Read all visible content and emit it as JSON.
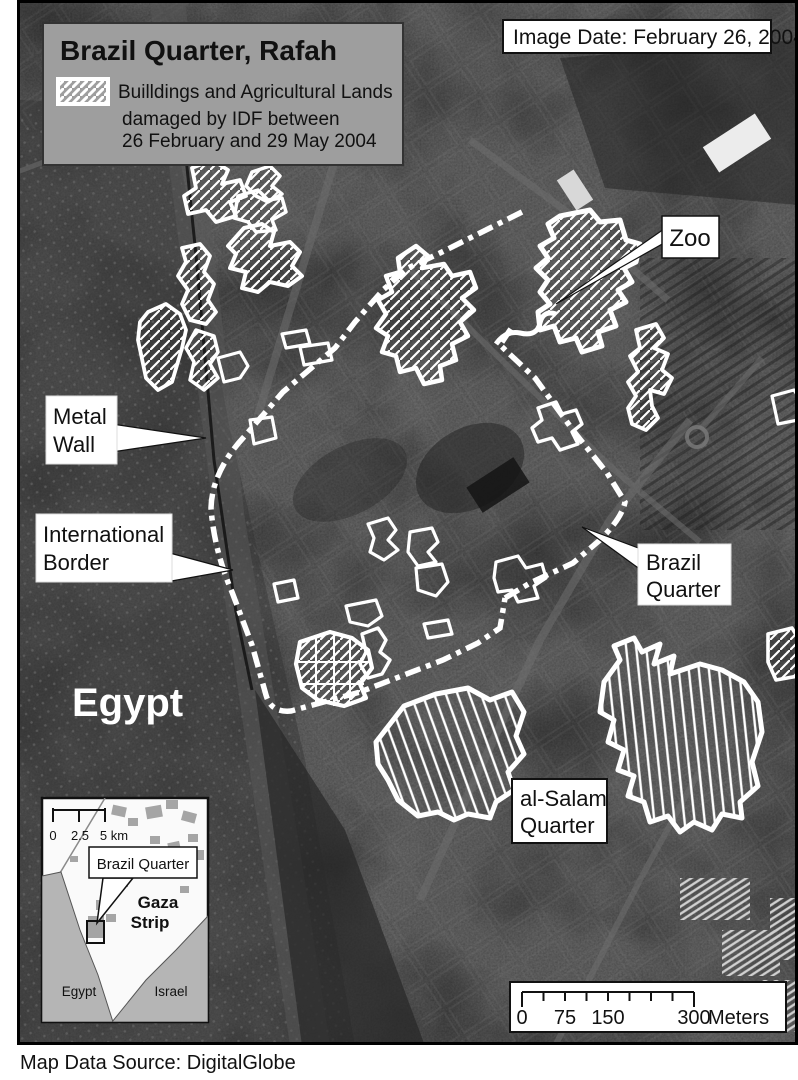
{
  "colors": {
    "map_background": "#3b3b3b",
    "panel_gray": "#9e9e9e",
    "callout_white": "#ffffff",
    "outline_black": "#111111",
    "damage_outline_white": "#ffffff",
    "inset_neighbor_gray": "#b5b5b5"
  },
  "title_panel": {
    "title": "Brazil Quarter, Rafah",
    "legend_line1": "Builldings and Agricultural Lands",
    "legend_line2": "damaged by IDF between",
    "legend_line3": "26 February and 29 May 2004"
  },
  "image_date_label": "Image Date: February 26, 2004",
  "map_labels": {
    "zoo": "Zoo",
    "metal_wall_line1": "Metal",
    "metal_wall_line2": "Wall",
    "border_line1": "International",
    "border_line2": "Border",
    "egypt": "Egypt",
    "brazil_quarter_line1": "Brazil",
    "brazil_quarter_line2": "Quarter",
    "al_salam_line1": "al-Salam",
    "al_salam_line2": "Quarter"
  },
  "inset_map": {
    "scale_zero": "0",
    "scale_mid": "2.5",
    "scale_end": "5 km",
    "callout": "Brazil Quarter",
    "gaza_line1": "Gaza",
    "gaza_line2": "Strip",
    "egypt": "Egypt",
    "israel": "Israel"
  },
  "scale_bar": {
    "tick0": "0",
    "tick1": "75",
    "tick2": "150",
    "tick3": "300",
    "unit": "Meters"
  },
  "credit": "Map Data Source: DigitalGlobe"
}
